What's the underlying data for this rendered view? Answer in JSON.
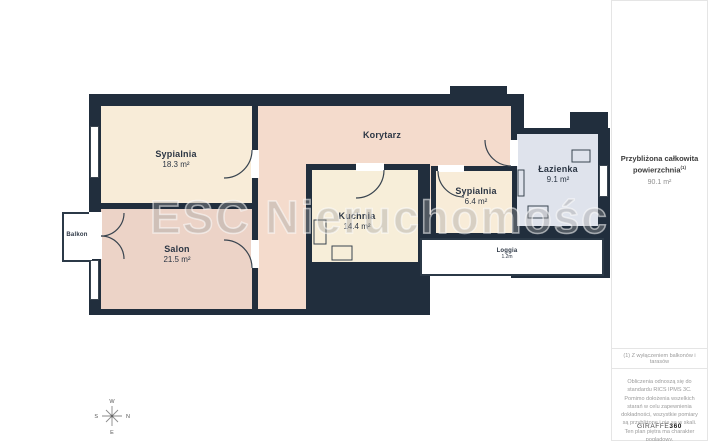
{
  "plan": {
    "watermark": "ESC Nieruchomości",
    "rooms": [
      {
        "name": "Sypialnia",
        "area": "18.3 m²"
      },
      {
        "name": "Salon",
        "area": "21.5 m²"
      },
      {
        "name": "Korytarz",
        "area": ""
      },
      {
        "name": "Kuchnia",
        "area": "14.4 m²"
      },
      {
        "name": "Sypialnia",
        "area": "6.4 m²"
      },
      {
        "name": "Łazienka",
        "area": "9.1 m²"
      },
      {
        "name": "Loggia",
        "area": "1.2m"
      },
      {
        "name": "Balkon",
        "area": ""
      }
    ],
    "colors": {
      "wall": "#212e3d",
      "bedroom": "#f8ecd8",
      "living": "#ecd3c7",
      "corridor": "#f4dbcc",
      "kitchen": "#f7eed9",
      "bathroom": "#dfe3ec"
    }
  },
  "compass": {
    "top": "W",
    "right": "N",
    "bottom": "E",
    "left": "S"
  },
  "sidebar": {
    "total_title": "Przybliżona całkowita powierzchnia",
    "total_sup": "(1)",
    "total_value": "90.1 m²",
    "footnote": "(1) Z wyłączeniem balkonów i tarasów",
    "disclaimer": "Obliczenia odnoszą się do standardu RICS IPMS 3C. Pomimo dołożenia wszelkich starań w celu zapewnienia dokładności, wszystkie pomiary są przybliżone i nie są w skali. Ten plan piętra ma charakter poglądowy.",
    "logo_prefix": "GIRAFFE",
    "logo_suffix": "360"
  }
}
